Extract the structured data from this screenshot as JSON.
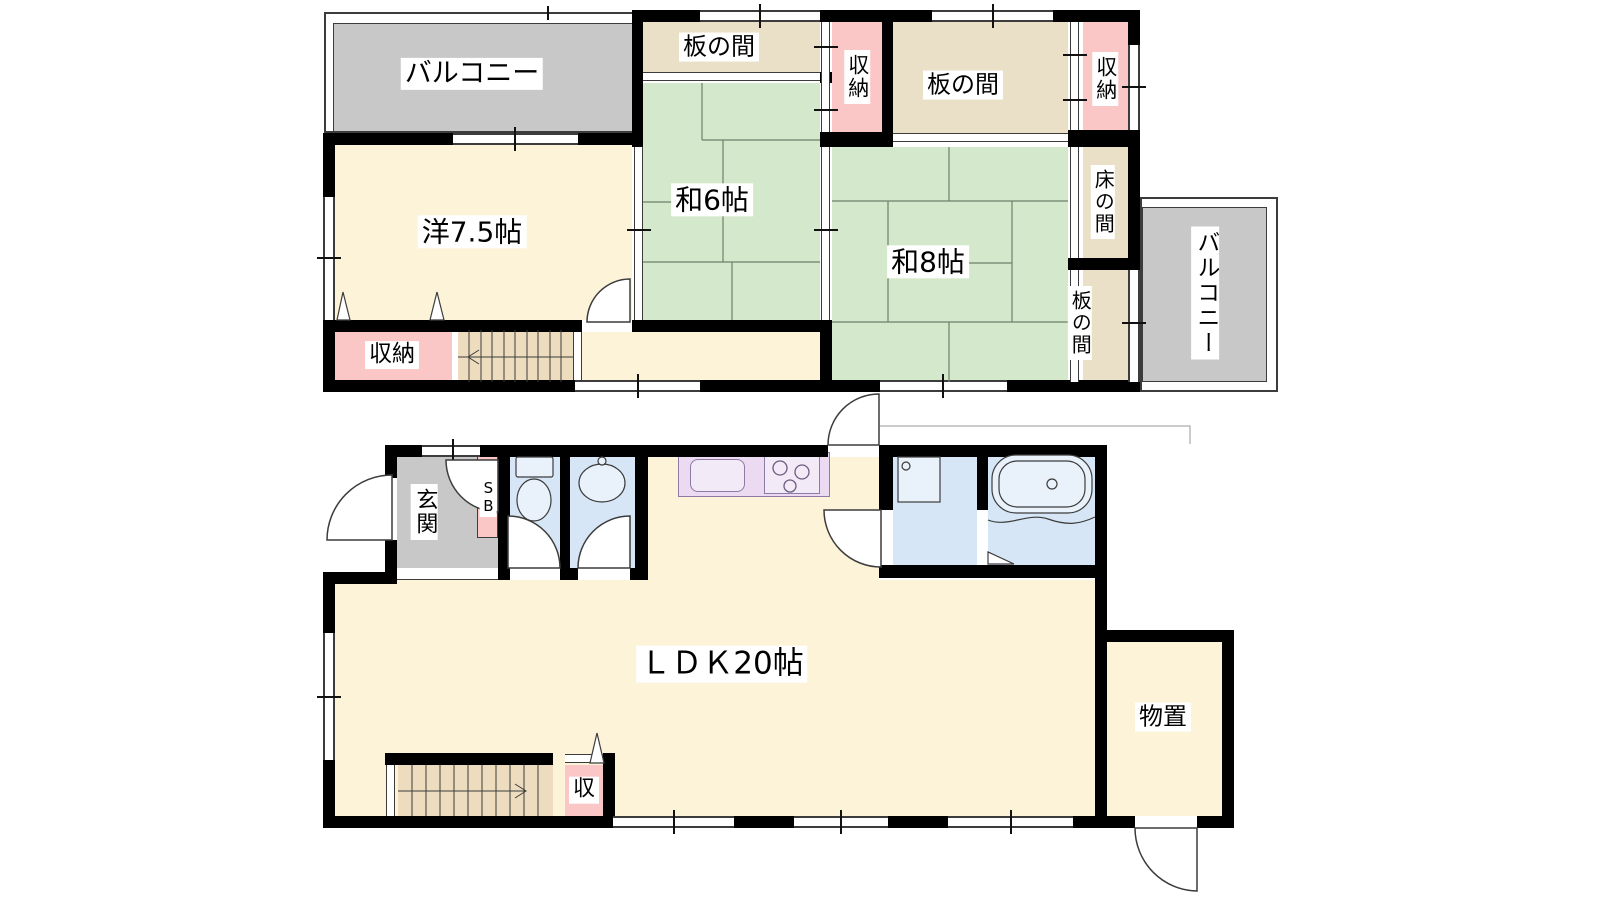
{
  "floor2": {
    "balcony_top": "バルコニー",
    "itanoma_top": "板の間",
    "closet_mid": "収納",
    "itanoma_right": "板の間",
    "closet_right": "収納",
    "western_room": "洋7.5帖",
    "tatami6": "和6帖",
    "tatami8": "和8帖",
    "tokonoma": "床の間",
    "itanoma_side": "板の間",
    "balcony_right": "バルコニー",
    "closet_bottom": "収納"
  },
  "floor1": {
    "entrance": "玄関",
    "shoe_box": "SB",
    "ldk": "ＬＤＫ20帖",
    "closet": "収",
    "storage": "物置"
  },
  "palette": {
    "wall": "#000000",
    "line": "#3c3c3c",
    "room_cream": "#fcf3d8",
    "tatami_green": "#d4e8cc",
    "wood_tan": "#eadfc7",
    "closet_pink": "#fbc6c6",
    "balcony_gray": "#c8c8c8",
    "water_blue": "#d6e6f6",
    "kitchen_purple": "#ebdaf2",
    "stairs_tan": "#eddcbe"
  }
}
